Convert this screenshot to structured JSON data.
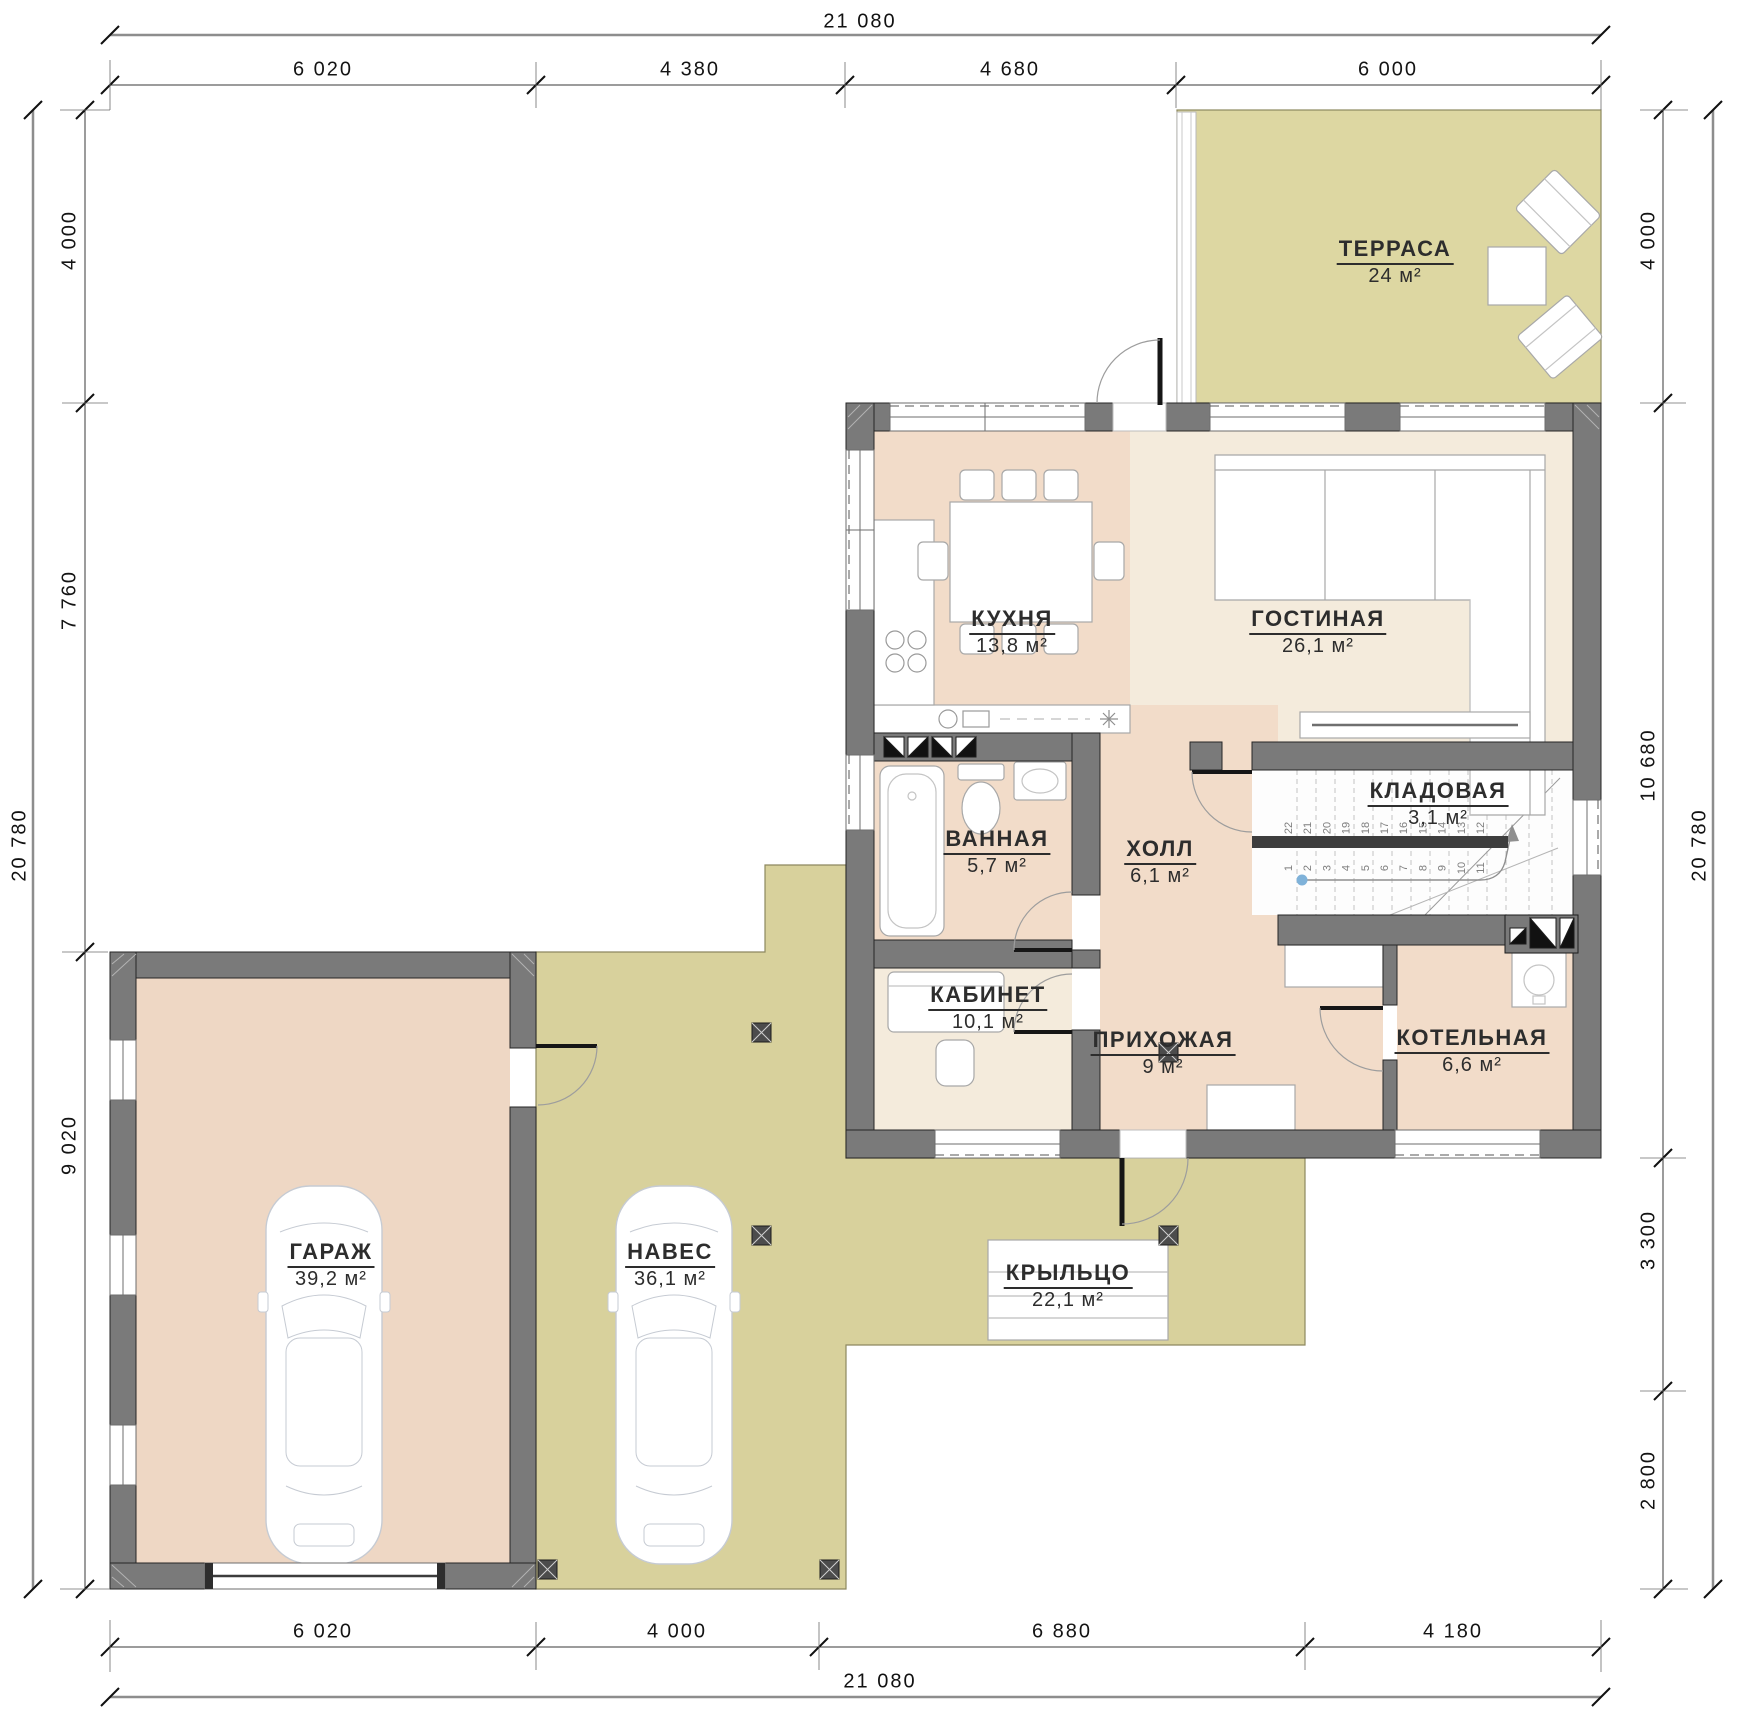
{
  "drawing": {
    "type": "floor-plan",
    "language": "ru",
    "area_unit": "м²"
  },
  "colors": {
    "wall_fill": "#7a7a7a",
    "wall_outline": "#262626",
    "floor_warm_pink": "#f2dcc9",
    "floor_cream": "#f4ebdc",
    "outdoor_olive": "#d8d19c",
    "terrace_olive": "#ddd7a2",
    "dim_line": "#3a3a3a",
    "stair_marker_blue": "#7fb2d9"
  },
  "rooms": {
    "terrace": {
      "name": "ТЕРРАСА",
      "area": "24 м²"
    },
    "kitchen": {
      "name": "КУХНЯ",
      "area": "13,8 м²"
    },
    "living": {
      "name": "ГОСТИНАЯ",
      "area": "26,1 м²"
    },
    "bathroom": {
      "name": "ВАННАЯ",
      "area": "5,7 м²"
    },
    "hall": {
      "name": "ХОЛЛ",
      "area": "6,1 м²"
    },
    "storage": {
      "name": "КЛАДОВАЯ",
      "area": "3,1 м²"
    },
    "office": {
      "name": "КАБИНЕТ",
      "area": "10,1 м²"
    },
    "entry": {
      "name": "ПРИХОЖАЯ",
      "area": "9 м²"
    },
    "boiler": {
      "name": "КОТЕЛЬНАЯ",
      "area": "6,6 м²"
    },
    "garage": {
      "name": "ГАРАЖ",
      "area": "39,2 м²"
    },
    "carport": {
      "name": "НАВЕС",
      "area": "36,1 м²"
    },
    "porch": {
      "name": "КРЫЛЬЦО",
      "area": "22,1 м²"
    }
  },
  "dimensions": {
    "top": {
      "total": "21 080",
      "segments": [
        "6 020",
        "4 380",
        "4 680",
        "6 000"
      ]
    },
    "bottom": {
      "total": "21 080",
      "segments": [
        "6 020",
        "4 000",
        "6 880",
        "4 180"
      ]
    },
    "left": {
      "total": "20 780",
      "segments": [
        "4 000",
        "7 760",
        "9 020"
      ]
    },
    "right": {
      "total": "20 780",
      "segments": [
        "4 000",
        "10 680",
        "3 300",
        "2 800"
      ]
    }
  },
  "stairs": {
    "upper_treads": [
      "22",
      "21",
      "20",
      "19",
      "18",
      "17",
      "16",
      "15",
      "14",
      "13",
      "12"
    ],
    "lower_treads": [
      "1",
      "2",
      "3",
      "4",
      "5",
      "6",
      "7",
      "8",
      "9",
      "10",
      "11"
    ]
  }
}
